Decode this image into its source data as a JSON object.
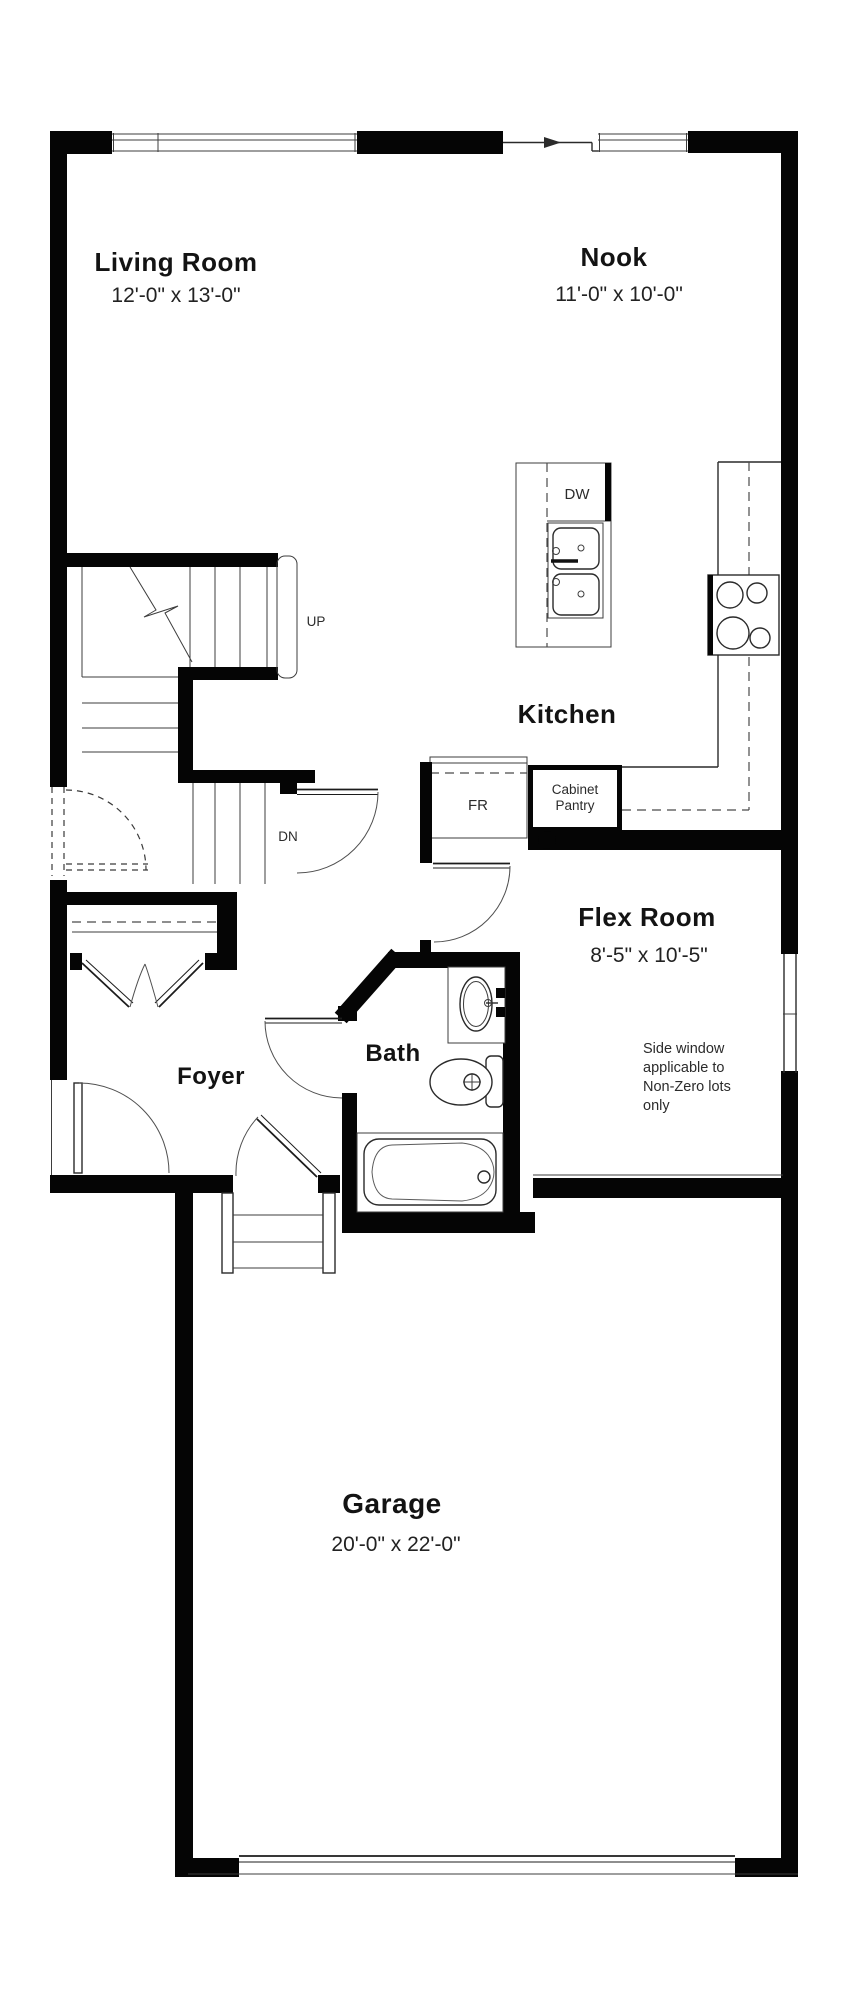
{
  "plan": {
    "rooms": {
      "living_room": {
        "label": "Living Room",
        "dims": "12'-0\" x 13'-0\""
      },
      "nook": {
        "label": "Nook",
        "dims": "11'-0\" x 10'-0\""
      },
      "kitchen": {
        "label": "Kitchen"
      },
      "flex_room": {
        "label": "Flex Room",
        "dims": "8'-5\" x 10'-5\""
      },
      "bath": {
        "label": "Bath"
      },
      "foyer": {
        "label": "Foyer"
      },
      "garage": {
        "label": "Garage",
        "dims": "20'-0\" x 22'-0\""
      }
    },
    "stairs": {
      "up_label": "UP",
      "down_label": "DN"
    },
    "appliances": {
      "dishwasher": "DW",
      "fridge": "FR",
      "pantry_line1": "Cabinet",
      "pantry_line2": "Pantry"
    },
    "note": {
      "line1": "Side window",
      "line2": "applicable to",
      "line3": "Non-Zero lots",
      "line4": "only"
    },
    "colors": {
      "wall": "#050505",
      "line": "#3d3d3d",
      "text": "#131313"
    }
  }
}
